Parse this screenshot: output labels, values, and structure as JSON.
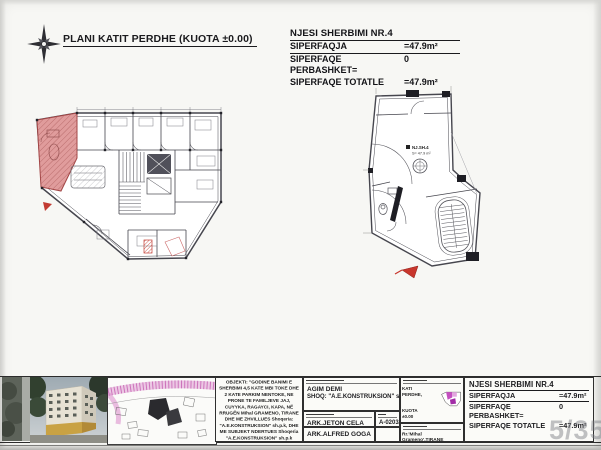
{
  "header": {
    "title": "PLANI KATIT PERDHE (KUOTA ±0.00)"
  },
  "unit_info": {
    "title": "NJESI SHERBIMI NR.4",
    "rows": [
      {
        "label": "SIPERFAQJA",
        "value": "=47.9m²"
      },
      {
        "label": "SIPERFAQE PERBASHKET=",
        "value": "0"
      },
      {
        "label": "SIPERFAQE TOTATLE",
        "value": "=47.9m²"
      }
    ]
  },
  "right_plan": {
    "unit_label": "NJ.SH.4",
    "area_label": "S= 47.9 m²"
  },
  "titleblock": {
    "objekti": "OBJEKTI: \"GODINE BANIMI E SHERBIMI 4,5 KATE MBI TOKE DHE 2 KATE PARKIM NENTOKE, NE PRONE TE FAMILJEVE JAJ, CUYYKA, RAGAYCI, KAPA, NË RRUGËN Mihal GRAMENO, TIRANE DHE ME ZHVILLUES Shoqeria: \"A.E.KONSTRUKSION\" sh.p.k, DHE ME SUBJEKT NDERTUES Shoqeria \"A.E.KONSTRUKSION\" sh.p.k",
    "investor_name": "AGIM DEMI",
    "investor_company": "SHOQ: \"A.E.KONSTRUKSION\" sh.p.k",
    "architect_1": "ARK.JETON CELA",
    "license_1": "A-0203/3",
    "architect_2": "ARK.ALFRED GOGA",
    "floor_label": "KATI PERDHE,",
    "floor_quota": "KUOTA ±0.00",
    "address": "Rr.'Mihal Grameno',TIRANE"
  },
  "watermark": "5/35",
  "colors": {
    "highlight_unit": "#e09c9c",
    "keyplan_accent": "#b841b8",
    "road_pink": "#d77ec5",
    "wall_line": "#46464e"
  }
}
